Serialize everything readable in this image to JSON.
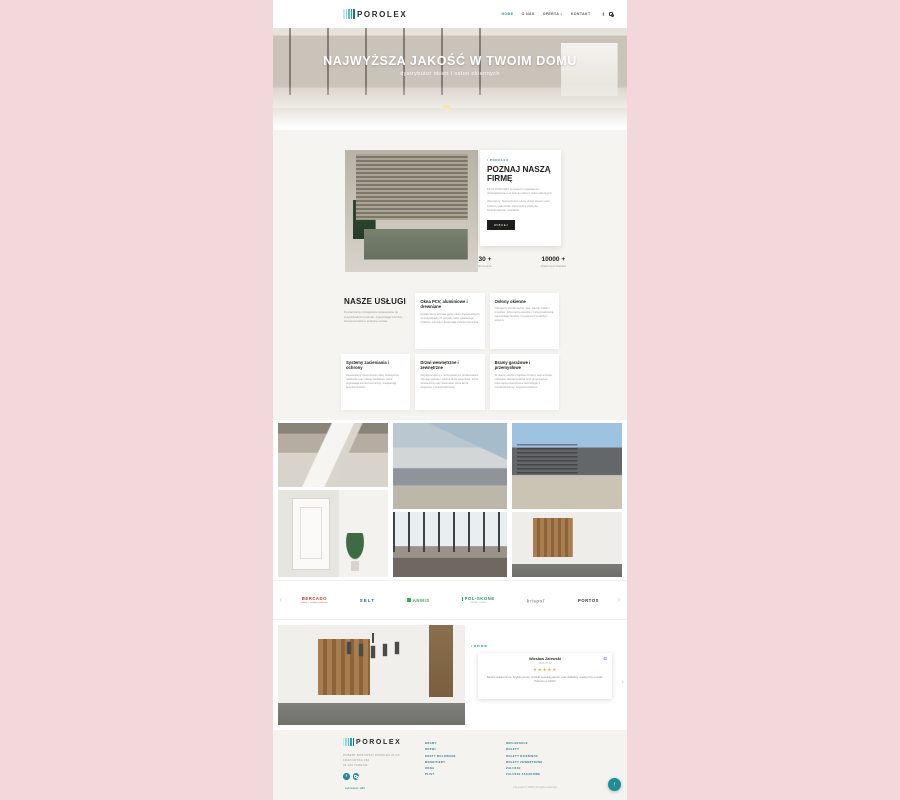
{
  "theme": {
    "page_background": "#f2d8da",
    "accent_teal": "#1e8e96",
    "dark": "#1d1d1b",
    "section_bg": "#f5f4f1",
    "star_color": "#f2a23a",
    "google_blue": "#4285F4"
  },
  "icons": {
    "chevron_down": "∨",
    "facebook": "f",
    "arrow_left": "‹",
    "arrow_right": "›",
    "scroll_top": "↑",
    "google": "G"
  },
  "header": {
    "logo": "POROLEX",
    "nav": [
      {
        "label": "HOME",
        "active": true
      },
      {
        "label": "O NAS",
        "active": false
      },
      {
        "label": "OFERTA",
        "active": false,
        "has_dropdown": true
      },
      {
        "label": "KONTAKT",
        "active": false
      }
    ]
  },
  "hero": {
    "title": "NAJWYŻSZA JAKOŚĆ W TWOIM DOMU",
    "subtitle": "dystrybutor okien i osłon okiennych"
  },
  "about": {
    "tag": "/ POROLEX",
    "title": "POZNAJ NASZĄ FIRMĘ",
    "paragraph1": "Firma POROLEX to zespół z wieloletnim doświadczeniem w branży okien i osłon okiennych.",
    "paragraph2": "Oferujemy: Nowoczesne okna, drzwi, bramy oraz systemy osłonowe, które łączą estetykę, funkcjonalność i trwałość.",
    "button": "WIĘCEJ",
    "stats": [
      {
        "value": "30 +",
        "label": "lat na rynku"
      },
      {
        "value": "10000 +",
        "label": "obsłużonych klientów"
      }
    ]
  },
  "services": {
    "title": "NASZE USŁUGI",
    "intro": "Dostarczamy rozwiązania dopasowane do indywidualnych potrzeb, zapewniając komfort, bezpieczeństwo i estetykę na lata.",
    "cards": [
      {
        "title": "Okna PCV, aluminiowe i drewniane",
        "text": "Dostarczamy szeroką gamę okien dopasowanych do indywidualnych potrzeb, które gwarantują trwałość, estetykę i doskonałą izolację termiczną."
      },
      {
        "title": "Osłony okienne",
        "text": "Oferujemy szeroki wybór rolet, żaluzji, markiz i moskitier, które łączą estetykę z funkcjonalnością, zapewniając komfort i prywatność w każdym wnętrzu."
      },
      {
        "title": "Systemy zacieniania i ochrony",
        "text": "Zapewniamy nowoczesne rolety zewnętrzne, refleksole oraz żaluzje fasadowe, które poprawiają komfort termiczny i zwiększają bezpieczeństwo."
      },
      {
        "title": "Drzwi wewnętrzne i zewnętrzne",
        "text": "Współpracujemy z renomowanymi producentami, oferując stylowe i solidne drzwi wejściowe, drzwi wewnętrzne oraz drewniane, które łączą elegancję z funkcjonalnością."
      },
      {
        "title": "Bramy garażowe i przemysłowe",
        "text": "W naszej ofercie znajdziesz bramy segmentowe, rolowane, dwuskrzydłowe oraz przemysłowe, które łączą nowoczesne technologie z niezawodnością i bezpieczeństwem."
      }
    ]
  },
  "brands": [
    {
      "name": "BERCADO",
      "tagline": "rolety i osłony okienne",
      "color": "#c4372f"
    },
    {
      "name": "SELT",
      "tagline": "",
      "color": "#2f4e9e"
    },
    {
      "name": "ANWIS",
      "tagline": "",
      "color": "#3ba55d"
    },
    {
      "name": "POL-SKONE",
      "tagline": "DRZWI OKNA",
      "color": "#1f9d55"
    },
    {
      "name": "krispol",
      "tagline": "",
      "color": "#8a8a8a"
    },
    {
      "name": "PORTOS",
      "tagline": "",
      "color": "#3a3a3a"
    }
  ],
  "reviews": {
    "tag": "/ OPINIE",
    "review": {
      "name": "Wiesław Zalewski",
      "date": "2025-05-12",
      "rating": 5,
      "stars": "★★★★★",
      "text": "Bardzo solidna firma. Szybki pomiar, produkt wysokiej jakości, oraz dokładny i estetyczny montaż. Polecam w 100%!"
    }
  },
  "footer": {
    "logo": "POROLEX",
    "company_lines": [
      "ROBERT BOROWSKI POROLEX-PLUS",
      "KRAKOWSKA 262",
      "33-100 TARNÓW"
    ],
    "links_col1": [
      "BRAMY",
      "DRZWI",
      "KRATY ROLOWANE",
      "MOSKITIERY",
      "OKNA",
      "PLISY"
    ],
    "links_col2": [
      "REFLEKSOLE",
      "ROLETY",
      "ROLETY DZIEŃ/NOC",
      "ROLETY ZEWNĘTRZNE",
      "ŻALUZJE",
      "ŻALUZJE FASADOWE"
    ],
    "credit": "wykonanie: eBiz",
    "copyright": "Copyright © 2025. All rights reserved."
  }
}
